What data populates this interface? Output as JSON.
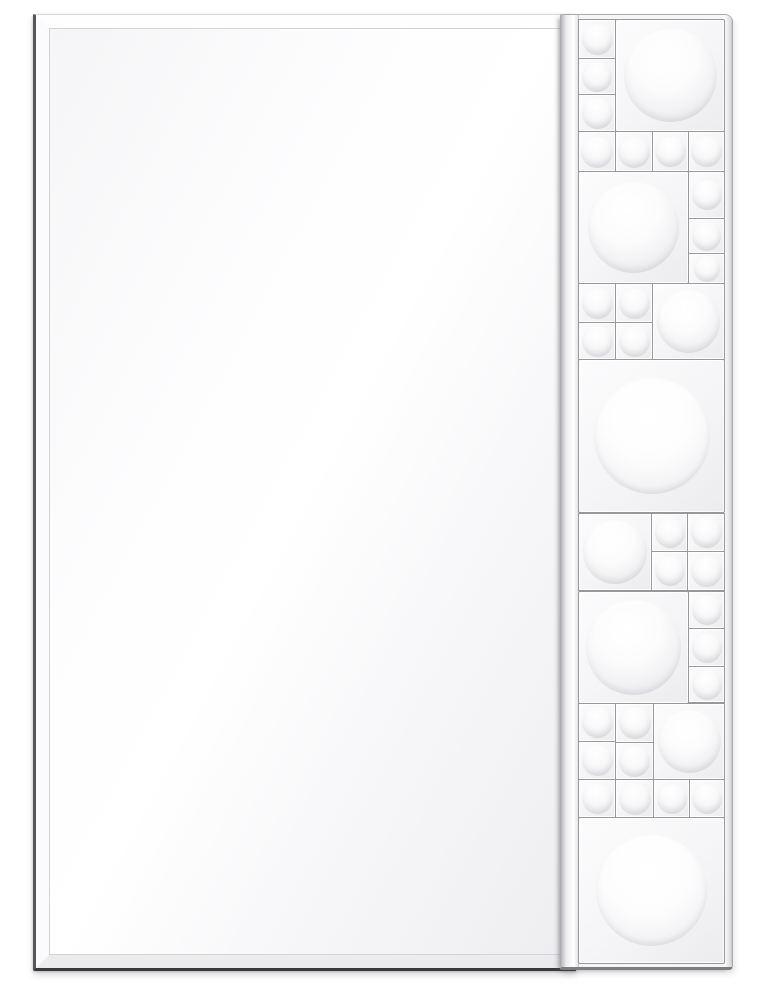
{
  "meta": {
    "subject": "frameless rectangular wall mirror with decorative bubble-glass mosaic strip on right edge",
    "visible_text": []
  },
  "palette": {
    "bg": "#ffffff",
    "grout": "#97979c",
    "glass_edge_dark": "#3a3a3e",
    "glass_edge_left": "#55555a",
    "bevel_light": "#fefefe",
    "bevel_shade": "#ececef",
    "tile_face": "#f5f5f7",
    "bubble_core": "#ffffff",
    "bubble_rim": "#e6e6ea"
  },
  "scene": {
    "mirror": {
      "x": 33,
      "y": 14,
      "width": 540,
      "height": 953,
      "bevel_width": 13
    },
    "strip": {
      "x": 560,
      "y": 14,
      "width": 171,
      "height": 952,
      "left_face_width": 17,
      "right_face_width": 8
    },
    "tiles": [
      {
        "x": 578,
        "y": 19,
        "w": 36,
        "h": 38,
        "b": 31,
        "kind": "small"
      },
      {
        "x": 578,
        "y": 58,
        "w": 36,
        "h": 35,
        "b": 30,
        "kind": "small"
      },
      {
        "x": 578,
        "y": 94,
        "w": 36,
        "h": 36,
        "b": 31,
        "kind": "small"
      },
      {
        "x": 615,
        "y": 19,
        "w": 108,
        "h": 111,
        "b": 93,
        "kind": "large"
      },
      {
        "x": 578,
        "y": 131,
        "w": 36,
        "h": 39,
        "b": 32,
        "kind": "small"
      },
      {
        "x": 615,
        "y": 131,
        "w": 36,
        "h": 39,
        "b": 32,
        "kind": "small"
      },
      {
        "x": 652,
        "y": 131,
        "w": 35,
        "h": 39,
        "b": 31,
        "kind": "small"
      },
      {
        "x": 688,
        "y": 131,
        "w": 35,
        "h": 39,
        "b": 31,
        "kind": "small"
      },
      {
        "x": 578,
        "y": 171,
        "w": 109,
        "h": 111,
        "b": 91,
        "kind": "large"
      },
      {
        "x": 688,
        "y": 171,
        "w": 35,
        "h": 46,
        "b": 30,
        "kind": "small"
      },
      {
        "x": 688,
        "y": 218,
        "w": 35,
        "h": 34,
        "b": 29,
        "kind": "small"
      },
      {
        "x": 688,
        "y": 253,
        "w": 35,
        "h": 29,
        "b": 26,
        "kind": "small"
      },
      {
        "x": 578,
        "y": 283,
        "w": 36,
        "h": 38,
        "b": 31,
        "kind": "small"
      },
      {
        "x": 615,
        "y": 283,
        "w": 36,
        "h": 38,
        "b": 31,
        "kind": "small"
      },
      {
        "x": 578,
        "y": 322,
        "w": 36,
        "h": 36,
        "b": 31,
        "kind": "small"
      },
      {
        "x": 615,
        "y": 322,
        "w": 36,
        "h": 36,
        "b": 31,
        "kind": "small"
      },
      {
        "x": 652,
        "y": 283,
        "w": 71,
        "h": 75,
        "b": 63,
        "kind": "medium"
      },
      {
        "x": 578,
        "y": 359,
        "w": 145,
        "h": 152,
        "b": 116,
        "kind": "giant"
      },
      {
        "x": 578,
        "y": 513,
        "w": 72,
        "h": 76,
        "b": 64,
        "kind": "medium"
      },
      {
        "x": 651,
        "y": 513,
        "w": 35,
        "h": 37,
        "b": 30,
        "kind": "small"
      },
      {
        "x": 687,
        "y": 513,
        "w": 36,
        "h": 37,
        "b": 31,
        "kind": "small"
      },
      {
        "x": 651,
        "y": 551,
        "w": 35,
        "h": 38,
        "b": 30,
        "kind": "small"
      },
      {
        "x": 687,
        "y": 551,
        "w": 36,
        "h": 38,
        "b": 31,
        "kind": "small"
      },
      {
        "x": 578,
        "y": 591,
        "w": 109,
        "h": 111,
        "b": 95,
        "kind": "large"
      },
      {
        "x": 688,
        "y": 591,
        "w": 35,
        "h": 36,
        "b": 30,
        "kind": "small"
      },
      {
        "x": 688,
        "y": 628,
        "w": 35,
        "h": 37,
        "b": 30,
        "kind": "small"
      },
      {
        "x": 688,
        "y": 666,
        "w": 35,
        "h": 35,
        "b": 30,
        "kind": "small"
      },
      {
        "x": 578,
        "y": 703,
        "w": 36,
        "h": 37,
        "b": 31,
        "kind": "small"
      },
      {
        "x": 615,
        "y": 703,
        "w": 37,
        "h": 38,
        "b": 32,
        "kind": "small"
      },
      {
        "x": 578,
        "y": 741,
        "w": 36,
        "h": 37,
        "b": 31,
        "kind": "small"
      },
      {
        "x": 615,
        "y": 742,
        "w": 37,
        "h": 36,
        "b": 31,
        "kind": "small"
      },
      {
        "x": 653,
        "y": 703,
        "w": 70,
        "h": 75,
        "b": 63,
        "kind": "medium"
      },
      {
        "x": 578,
        "y": 779,
        "w": 36,
        "h": 37,
        "b": 31,
        "kind": "small"
      },
      {
        "x": 615,
        "y": 779,
        "w": 37,
        "h": 37,
        "b": 32,
        "kind": "small"
      },
      {
        "x": 653,
        "y": 779,
        "w": 35,
        "h": 37,
        "b": 30,
        "kind": "small"
      },
      {
        "x": 689,
        "y": 779,
        "w": 34,
        "h": 37,
        "b": 30,
        "kind": "small"
      },
      {
        "x": 578,
        "y": 817,
        "w": 145,
        "h": 145,
        "b": 111,
        "kind": "giant"
      }
    ]
  }
}
